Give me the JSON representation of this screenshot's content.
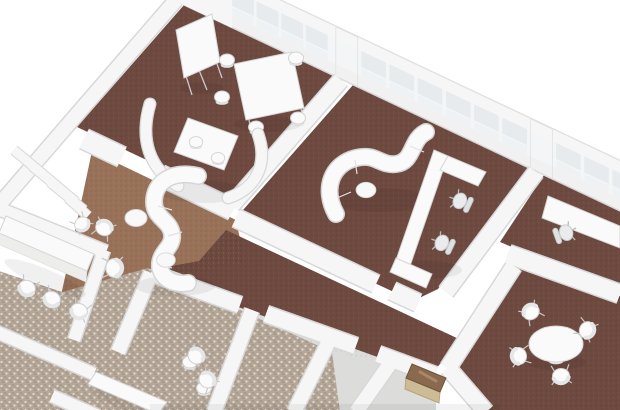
{
  "scene": {
    "kind": "3d-office-floorplan-render",
    "view": "axonometric-top-down",
    "background": "#ffffff"
  },
  "colors": {
    "carpet_dark": "#6e4a40",
    "carpet_tan": "#997259",
    "terrazzo_base": "#b5a798",
    "small_room_floor": "#dcdcda",
    "wall": "#f6f6f6",
    "wall_edge": "#d8d8d8",
    "sill": "#f1f1f1",
    "mullion_bg": "#f3f5f6",
    "glass_upper": "#e7ebee",
    "glass_lower": "#eff2f4",
    "furniture_white": "#fafafa",
    "furniture_edge": "#d6d6d6",
    "wood_top": "#8a6a4e",
    "wood_front": "#cdbb96"
  },
  "inventory": {
    "rooms": [
      "workshop room with flipchart and standing table",
      "lounge room with serpentine sofa and u-shaped desk",
      "office room right",
      "meeting room with round table",
      "open lounge with serpentine sofa",
      "corridor",
      "small back rooms"
    ],
    "furniture": [
      "flipchart easel",
      "standing table",
      "bar stool",
      "curved acoustic booth",
      "booth table",
      "serpentine sofa",
      "ottoman pouf",
      "u-shaped desk",
      "task chair",
      "office desk",
      "round meeting table",
      "shell chair",
      "long counter table",
      "low table",
      "wooden sideboard"
    ]
  }
}
